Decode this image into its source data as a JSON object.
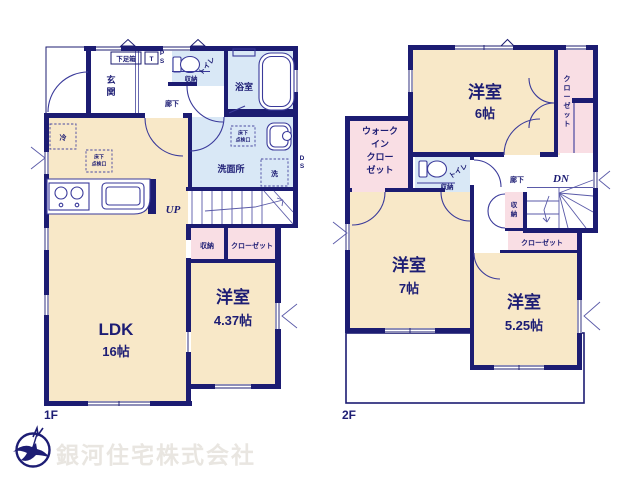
{
  "colors": {
    "wall_navy": "#1c1c72",
    "room_cream": "#f8e8c8",
    "wet_blue": "#d9e8f6",
    "closet_pink": "#f9dee4",
    "watermark_gray": "#e9e6e1"
  },
  "watermark": "銀河住宅株式会社",
  "floor1": {
    "label": "1F",
    "ldk": {
      "name": "LDK",
      "size": "16帖"
    },
    "bedroom": {
      "name": "洋室",
      "size": "4.37帖"
    },
    "genkan_chars": [
      "玄",
      "関"
    ],
    "shoe_box": "下足箱",
    "t_box": "T",
    "ps_chars": [
      "P",
      "S"
    ],
    "ds_chars": [
      "D",
      "S"
    ],
    "toilet": "トイレ",
    "toilet_storage": "収納",
    "bath": "浴室",
    "hallway": "廊下",
    "washroom": "洗面所",
    "laundry": "洗",
    "fridge": "冷",
    "hatch_lines": [
      "床下",
      "点検口"
    ],
    "up": "UP",
    "storage": "収納",
    "closet": "クローゼット"
  },
  "floor2": {
    "label": "2F",
    "bedroom6": {
      "name": "洋室",
      "size": "6帖"
    },
    "bedroom7": {
      "name": "洋室",
      "size": "7帖"
    },
    "bedroom5": {
      "name": "洋室",
      "size": "5.25帖"
    },
    "closet_side_chars": [
      "ク",
      "ロ",
      "ー",
      "ゼ",
      "ッ",
      "ト"
    ],
    "wic_lines": [
      "ウォーク",
      "イン",
      "クロー",
      "ゼット"
    ],
    "toilet": "トイレ",
    "toilet_storage": "収納",
    "hallway": "廊下",
    "dn": "DN",
    "storage_chars": [
      "収",
      "納"
    ],
    "closet": "クローゼット"
  }
}
